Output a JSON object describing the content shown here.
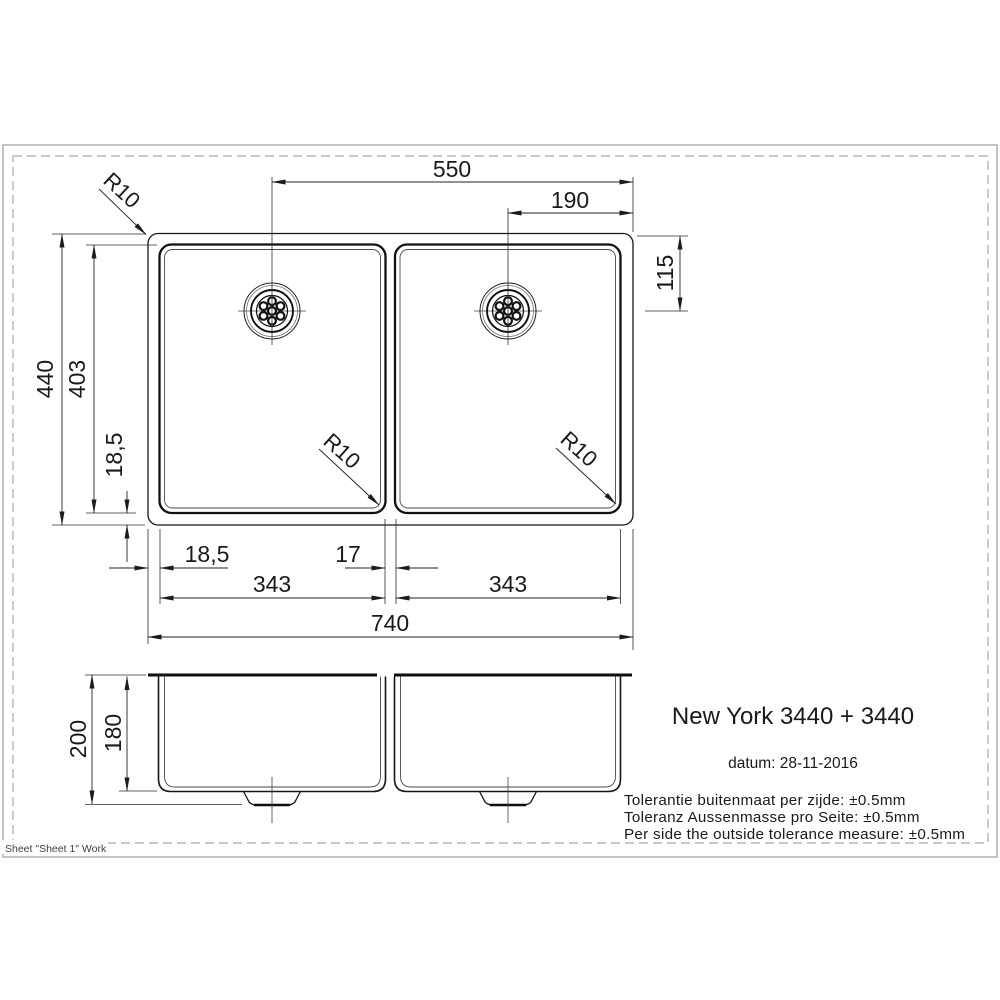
{
  "page": {
    "sheet_label": "Sheet \"Sheet 1\" Work"
  },
  "title_block": {
    "model": "New York 3440 + 3440",
    "date": "datum: 28-11-2016",
    "tolerances": [
      "Tolerantie buitenmaat per zijde: ±0.5mm",
      "Toleranz Aussenmasse pro Seite: ±0.5mm",
      "Per side the outside tolerance measure: ±0.5mm"
    ]
  },
  "top_view": {
    "dims": {
      "drain_to_right_edge": "550",
      "right_drain_to_edge": "190",
      "drain_from_top": "115",
      "outer_height": "440",
      "bowl_height": "403",
      "rim_bottom_left": "18,5",
      "rim_left": "18,5",
      "divider": "17",
      "left_bowl_width": "343",
      "right_bowl_width": "343",
      "total_width": "740"
    },
    "corner_radius_labels": [
      "R10",
      "R10",
      "R10"
    ]
  },
  "side_view": {
    "dims": {
      "total_depth": "200",
      "bowl_depth": "180"
    }
  }
}
